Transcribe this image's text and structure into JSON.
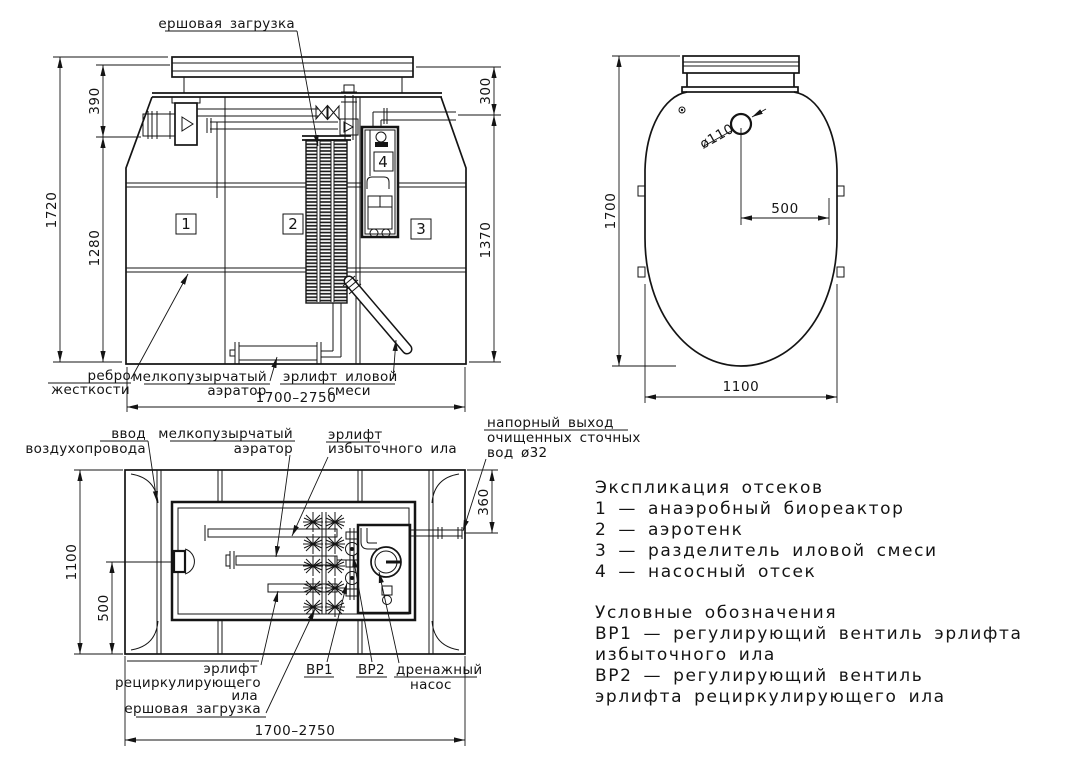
{
  "front_view": {
    "label_brush_load": "ершовая загрузка",
    "label_rib_line1": "ребро",
    "label_rib_line2": "жесткости",
    "label_aerator_line1": "мелкопузырчатый",
    "label_aerator_line2": "аэратор",
    "label_sludge_airlift_line1": "эрлифт иловой",
    "label_sludge_airlift_line2": "смеси",
    "compartment_1": "1",
    "compartment_2": "2",
    "compartment_3": "3",
    "compartment_4": "4",
    "dim_height_total": "1720",
    "dim_neck": "390",
    "dim_body": "1280",
    "dim_300": "300",
    "dim_1370": "1370",
    "dim_length": "1700–2750"
  },
  "top_view": {
    "dim_height": "1700",
    "dim_hole_offset": "500",
    "dim_width": "1100",
    "dim_hole": "ø110"
  },
  "plan_view": {
    "label_air_inlet_line1": "ввод",
    "label_air_inlet_line2": "воздухопровода",
    "label_aerator_line1": "мелкопузырчатый",
    "label_aerator_line2": "аэратор",
    "label_excess_airlift_line1": "эрлифт",
    "label_excess_airlift_line2": "избыточного ила",
    "label_outlet_line1": "напорный выход",
    "label_outlet_line2": "очищенных сточных",
    "label_outlet_line3": "вод ø32",
    "label_recirc_airlift_line1": "эрлифт",
    "label_recirc_airlift_line2": "рециркулирующего",
    "label_recirc_airlift_line3": "ила",
    "label_brush_load": "ершовая загрузка",
    "label_valve1": "ВР1",
    "label_valve2": "ВР2",
    "label_drain_pump_line1": "дренажный",
    "label_drain_pump_line2": "насос",
    "dim_width": "1100",
    "dim_500": "500",
    "dim_360": "360",
    "dim_length": "1700–2750"
  },
  "legend": {
    "title": "Экспликация отсеков",
    "items": [
      "1 — анаэробный биореактор",
      "2 — аэротенк",
      "3 — разделитель иловой смеси",
      "4 — насосный отсек"
    ],
    "symbols_title": "Условные обозначения",
    "symbols_lines": [
      "ВР1 — регулирующий вентиль эрлифта",
      "избыточного ила",
      "ВР2 — регулирующий вентиль",
      "эрлифта рециркулирующего ила"
    ]
  }
}
